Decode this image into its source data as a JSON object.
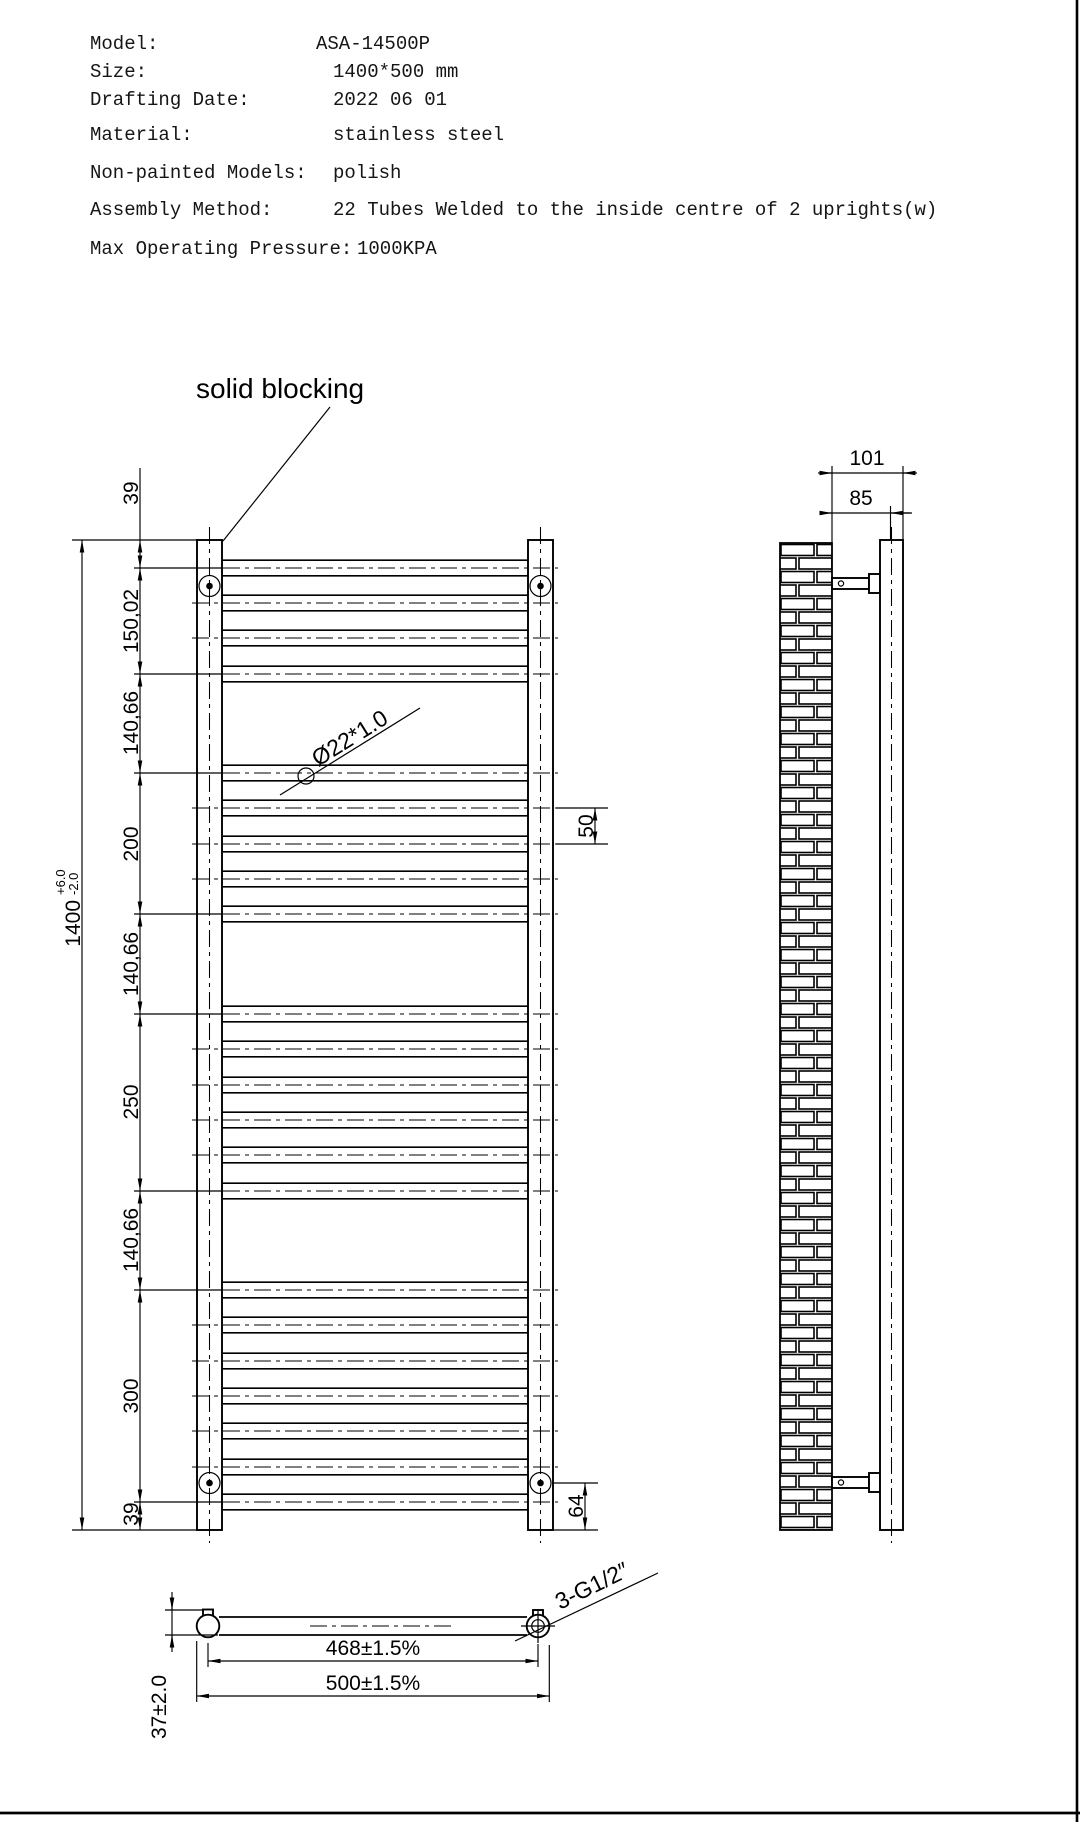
{
  "specs": {
    "rows": [
      {
        "label": "Model:",
        "value": "ASA-14500P"
      },
      {
        "label": "Size:",
        "value": "1400*500 mm"
      },
      {
        "label": "Drafting Date:",
        "value": "2022 06 01"
      },
      {
        "label": "Material:",
        "value": "stainless steel"
      },
      {
        "label": "Non-painted Models:",
        "value": "polish"
      },
      {
        "label": "Assembly Method:",
        "value": "22 Tubes Welded to the inside centre of 2 uprights(w)"
      },
      {
        "label": "Max Operating Pressure:",
        "value": "1000KPA"
      }
    ]
  },
  "front_view": {
    "solid_blocking_label": "solid blocking",
    "tube_spec_label": "Ø22*1.0",
    "tube_count": 22,
    "tube_groups_top_to_bottom": [
      4,
      5,
      6,
      7
    ]
  },
  "dimensions": {
    "left_chain": [
      "39",
      "150,02",
      "140,66",
      "200",
      "140,66",
      "250",
      "140,66",
      "300",
      "39"
    ],
    "overall_height": {
      "value": "1400",
      "tol_plus": "+6.0",
      "tol_minus": "-2.0"
    },
    "tube_pitch": "50",
    "bottom_bracket_offset": "64",
    "side_depth_total": "101",
    "side_depth_to_center": "85",
    "plan_centers_width": "468±1.5%",
    "plan_overall_width": "500±1.5%",
    "plan_wall_offset": "37±2.0",
    "ports_label": "3-G1/2″"
  }
}
